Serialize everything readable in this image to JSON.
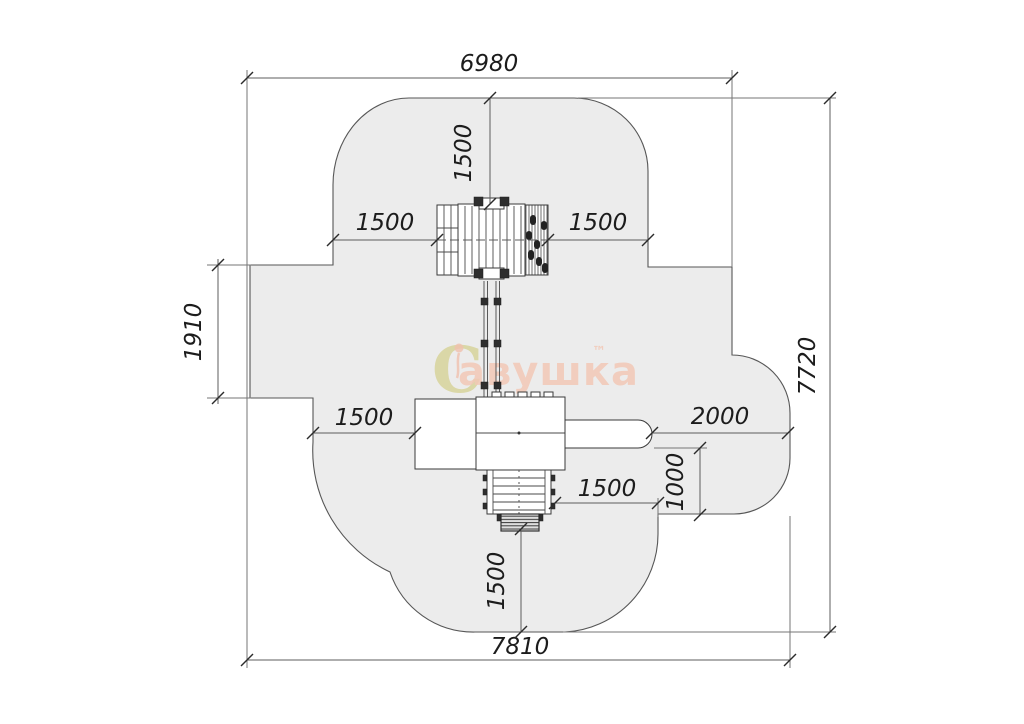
{
  "drawing": {
    "type": "playground-safety-zone-plan",
    "units": "mm"
  },
  "dimensions": {
    "top_width": "6980",
    "right_height": "7720",
    "bottom_width": "7810",
    "left_height": "1910",
    "top_to_equipment": "1500",
    "left_to_tower": "1500",
    "tower_to_right_edge": "1500",
    "left_to_platform": "1500",
    "stairs_to_right_edge": "1500",
    "stairs_to_bottom_edge": "1500",
    "slide_to_right_edge": "2000",
    "slide_side_clearance": "1000"
  },
  "watermark": {
    "swirl": "C",
    "text": "авушка",
    "tm": "™"
  },
  "colors": {
    "zone_fill": "#ececec",
    "zone_stroke": "#565656",
    "line": "#3a3a3a",
    "dim_text": "#1c1c1c",
    "watermark_pink": "#f2c8b6",
    "watermark_olive": "#d9d5a0"
  }
}
